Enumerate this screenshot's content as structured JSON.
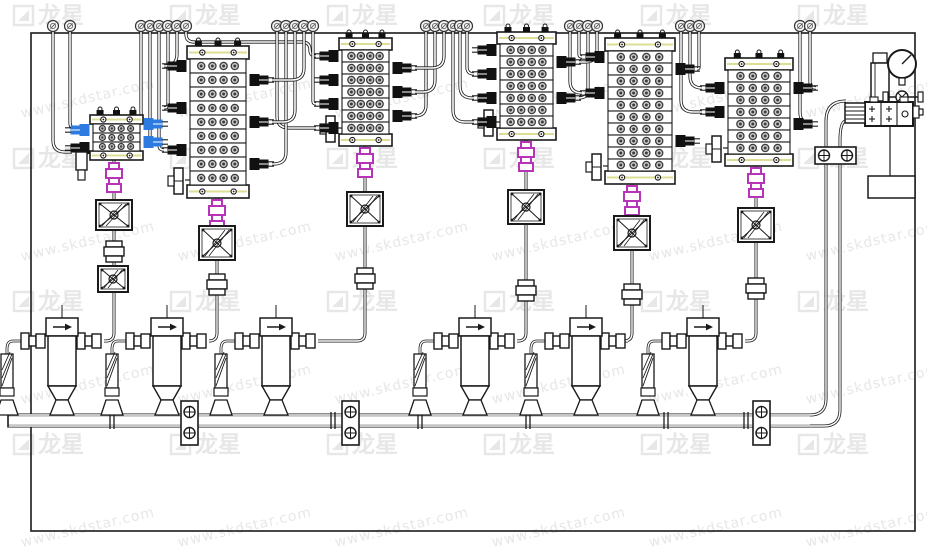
{
  "title": "lubrication-system-piping-diagram",
  "watermark": {
    "logo_text": "龙星",
    "url_text": "www.skdstar.com",
    "color": "#e7e7e7",
    "cols": 6,
    "rows": 4,
    "x0": 14,
    "y0": 6,
    "dx": 157,
    "dy": 143
  },
  "palette": {
    "line": "#1a1a1a",
    "magenta": "#b733b7",
    "blue": "#2d7be0",
    "yellow": "#dddd96",
    "port_fill": "#c9c9c9",
    "port_dark": "#3c3c3c",
    "watermark": "#e7e7e7"
  },
  "frame": {
    "x": 31,
    "y": 33,
    "w": 884,
    "h": 498
  },
  "balloons": {
    "y": 26,
    "r": 5.5,
    "xs": [
      53,
      70,
      141,
      150,
      159,
      168,
      177,
      186,
      277,
      286,
      295,
      304,
      313,
      426,
      435,
      444,
      453,
      460,
      467,
      570,
      579,
      588,
      597,
      681,
      690,
      699,
      800,
      810
    ]
  },
  "routes": [
    {
      "b": 53,
      "fy": 152,
      "tx": 72
    },
    {
      "b": 70,
      "fy": 130,
      "tx": 78
    },
    {
      "b": 141,
      "fy": 124,
      "tx": 156
    },
    {
      "b": 150,
      "fy": 142,
      "tx": 156
    },
    {
      "b": 159,
      "fy": 150,
      "tx": 164
    },
    {
      "b": 168,
      "fy": 108,
      "tx": 164
    },
    {
      "b": 177,
      "fy": 66,
      "tx": 164
    },
    {
      "b": 186,
      "type": "over",
      "yH": 42,
      "dx": 310,
      "fy": 56,
      "tx": 316
    },
    {
      "b": 277,
      "fy": 128,
      "tx": 316
    },
    {
      "b": 286,
      "fy": 164,
      "tx": 272
    },
    {
      "b": 295,
      "fy": 122,
      "tx": 272
    },
    {
      "b": 304,
      "fy": 80,
      "tx": 272
    },
    {
      "b": 313,
      "fy": 104,
      "tx": 316
    },
    {
      "b": 426,
      "fy": 116,
      "tx": 415
    },
    {
      "b": 435,
      "fy": 92,
      "tx": 415
    },
    {
      "b": 444,
      "fy": 68,
      "tx": 415
    },
    {
      "b": 453,
      "fy": 122,
      "tx": 474
    },
    {
      "b": 460,
      "fy": 98,
      "tx": 474
    },
    {
      "b": 467,
      "fy": 74,
      "tx": 474
    },
    {
      "b": 570,
      "fy": 93,
      "tx": 582
    },
    {
      "b": 579,
      "fy": 57,
      "tx": 582
    },
    {
      "b": 588,
      "fy": 98,
      "tx": 579
    },
    {
      "b": 597,
      "fy": 62,
      "tx": 579
    },
    {
      "b": 681,
      "fy": 112,
      "tx": 702
    },
    {
      "b": 690,
      "fy": 88,
      "tx": 702
    },
    {
      "b": 699,
      "fy": 69,
      "tx": 698
    },
    {
      "b": 800,
      "fy": 124,
      "tx": 812
    },
    {
      "b": 810,
      "fy": 88,
      "tx": 816
    }
  ],
  "blocks": [
    {
      "name": "distributor-small-left",
      "x": 93,
      "y": 115,
      "w": 47,
      "capH": 9,
      "rowH": 9,
      "rows": 3,
      "left": [],
      "right": [],
      "blueLeft": [
        130
      ],
      "blueRight": [
        124,
        142
      ],
      "stub": true,
      "lowValve": false
    },
    {
      "name": "distributor-1",
      "x": 190,
      "y": 46,
      "w": 56,
      "capH": 13,
      "rowH": 14,
      "rows": 9,
      "left": [
        66,
        108,
        150
      ],
      "right": [
        80,
        122,
        164
      ],
      "lowValve": true
    },
    {
      "name": "distributor-2",
      "x": 342,
      "y": 38,
      "w": 47,
      "capH": 12,
      "rowH": 12,
      "rows": 7,
      "left": [
        56,
        80,
        104,
        128
      ],
      "right": [
        68,
        92,
        116
      ],
      "lowValve": true
    },
    {
      "name": "distributor-3",
      "x": 500,
      "y": 32,
      "w": 53,
      "capH": 12,
      "rowH": 12,
      "rows": 7,
      "left": [
        50,
        74,
        98,
        122
      ],
      "right": [
        62,
        98
      ],
      "lowValve": true
    },
    {
      "name": "distributor-4",
      "x": 608,
      "y": 38,
      "w": 64,
      "capH": 13,
      "rowH": 12,
      "rows": 10,
      "left": [
        57,
        93
      ],
      "right": [
        69,
        141
      ],
      "lowValve": true
    },
    {
      "name": "distributor-5",
      "x": 728,
      "y": 58,
      "w": 62,
      "capH": 12,
      "rowH": 12,
      "rows": 7,
      "left": [
        88,
        112
      ],
      "right": [
        88,
        124
      ],
      "lowValve": true
    }
  ],
  "chains": [
    {
      "c": 114,
      "topY": 160,
      "magentaY": 163,
      "box": [
        96,
        200,
        36,
        30
      ],
      "box2": [
        98,
        266,
        30,
        26
      ],
      "nutY": 241,
      "end": 104
    },
    {
      "c": 217,
      "topY": 198,
      "magentaY": 200,
      "box": [
        199,
        226,
        36,
        34
      ],
      "nutY": 274,
      "end": 209
    },
    {
      "c": 365,
      "topY": 146,
      "magentaY": 148,
      "box": [
        347,
        192,
        36,
        34
      ],
      "nutY": 268,
      "end": 318
    },
    {
      "c": 526,
      "topY": 140,
      "magentaY": 142,
      "box": [
        508,
        190,
        36,
        34
      ],
      "nutY": 280,
      "end": 517
    },
    {
      "c": 632,
      "topY": 184,
      "magentaY": 186,
      "box": [
        614,
        216,
        36,
        34
      ],
      "nutY": 284,
      "end": 628
    },
    {
      "c": 756,
      "topY": 166,
      "magentaY": 168,
      "box": [
        738,
        208,
        36,
        34
      ],
      "nutY": 278,
      "end": 745
    }
  ],
  "units": {
    "cxs": [
      62,
      167,
      276,
      475,
      586,
      703
    ]
  },
  "brackets": {
    "vertical_x": [
      181,
      342,
      753
    ],
    "horizontal": {
      "x": 815,
      "y": 147,
      "w": 41,
      "h": 17
    }
  },
  "rail": {
    "y1": 415,
    "y2": 426,
    "x0": 8,
    "xElbow": 810,
    "ticks": [
      110,
      331,
      418,
      526,
      664,
      744
    ]
  },
  "riser": {
    "x1": 826,
    "x2": 840
  },
  "pump_station": {
    "gauge": {
      "cx": 902,
      "cy": 64,
      "r": 14
    },
    "body": [
      865,
      102,
      48,
      24
    ],
    "relief": [
      871,
      63,
      18,
      38
    ],
    "relief_cap": [
      873,
      53,
      14,
      10
    ],
    "lower_box": [
      868,
      176,
      47,
      22
    ],
    "cross_valve_y": 97
  }
}
